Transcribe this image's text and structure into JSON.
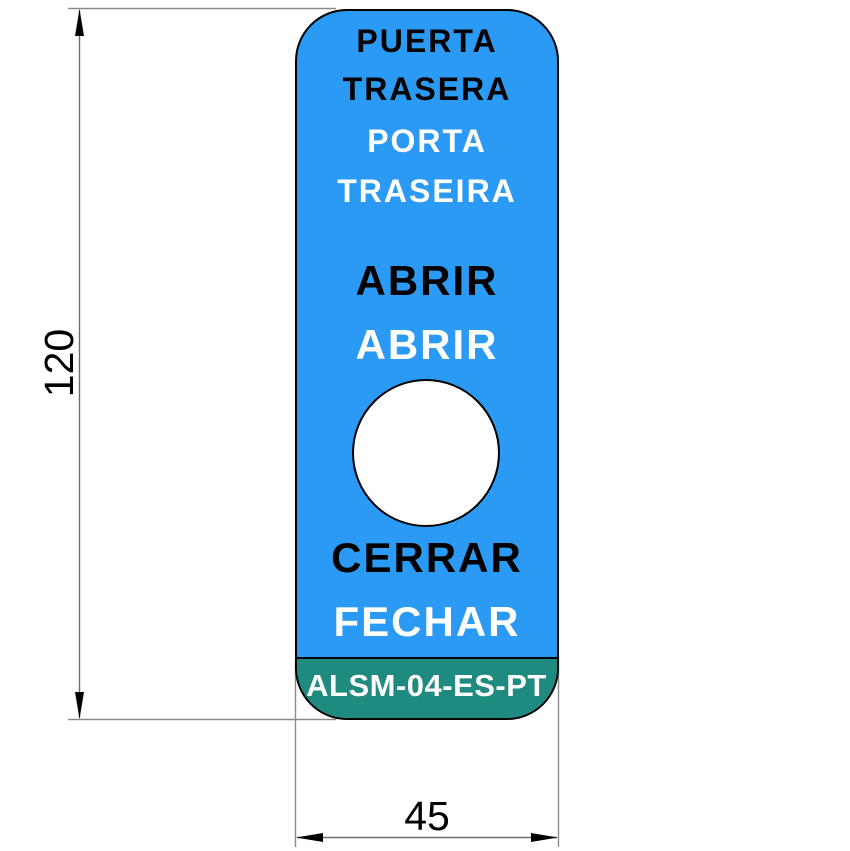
{
  "drawing": {
    "type": "label-plate-technical-drawing",
    "plate": {
      "door_name_es_line1": "PUERTA",
      "door_name_es_line2": "TRASERA",
      "door_name_pt_line1": "PORTA",
      "door_name_pt_line2": "TRASEIRA",
      "action_open_es": "ABRIR",
      "action_open_pt": "ABRIR",
      "action_close_es": "CERRAR",
      "action_close_pt": "FECHAR",
      "part_code": "ALSM-04-ES-PT"
    },
    "dimensions": {
      "height": "120",
      "width": "45"
    },
    "colors": {
      "plate_blue": "#2B9AF4",
      "band_teal": "#1F8A80",
      "outline_black": "#000000",
      "hole_white": "#FFFFFF",
      "dim_line_gray": "#6E6E6E"
    }
  }
}
